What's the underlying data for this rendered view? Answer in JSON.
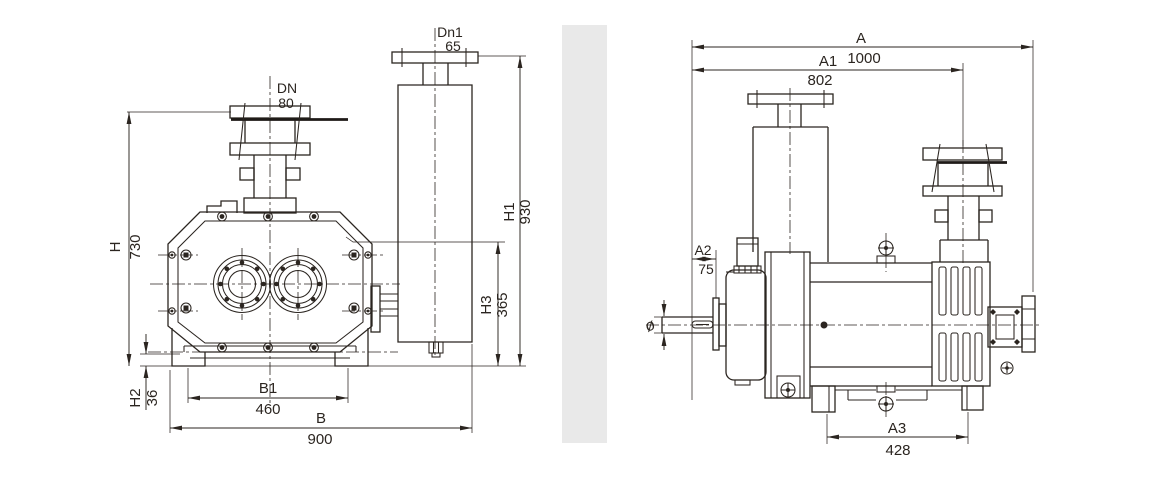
{
  "drawing": {
    "background_color": "#ffffff",
    "line_color": "#2b2520",
    "divider_color": "#e9e9e9",
    "front_view": {
      "inlet": {
        "label": "DN",
        "value": "80"
      },
      "outlet": {
        "label": "Dn1",
        "value": "65"
      },
      "dim_H": {
        "label": "H",
        "value": "730"
      },
      "dim_H1": {
        "label": "H1",
        "value": "930"
      },
      "dim_H2": {
        "label": "H2",
        "value": "36"
      },
      "dim_H3": {
        "label": "H3",
        "value": "365"
      },
      "dim_B1": {
        "label": "B1",
        "value": "460"
      },
      "dim_B": {
        "label": "B",
        "value": "900"
      }
    },
    "side_view": {
      "dim_A": {
        "label": "A",
        "value": "1000"
      },
      "dim_A1": {
        "label": "A1",
        "value": "802"
      },
      "dim_A2": {
        "label": "A2",
        "value": "75"
      },
      "dim_A3": {
        "label": "A3",
        "value": "428"
      },
      "shaft_dia": {
        "symbol": "ø"
      }
    }
  }
}
